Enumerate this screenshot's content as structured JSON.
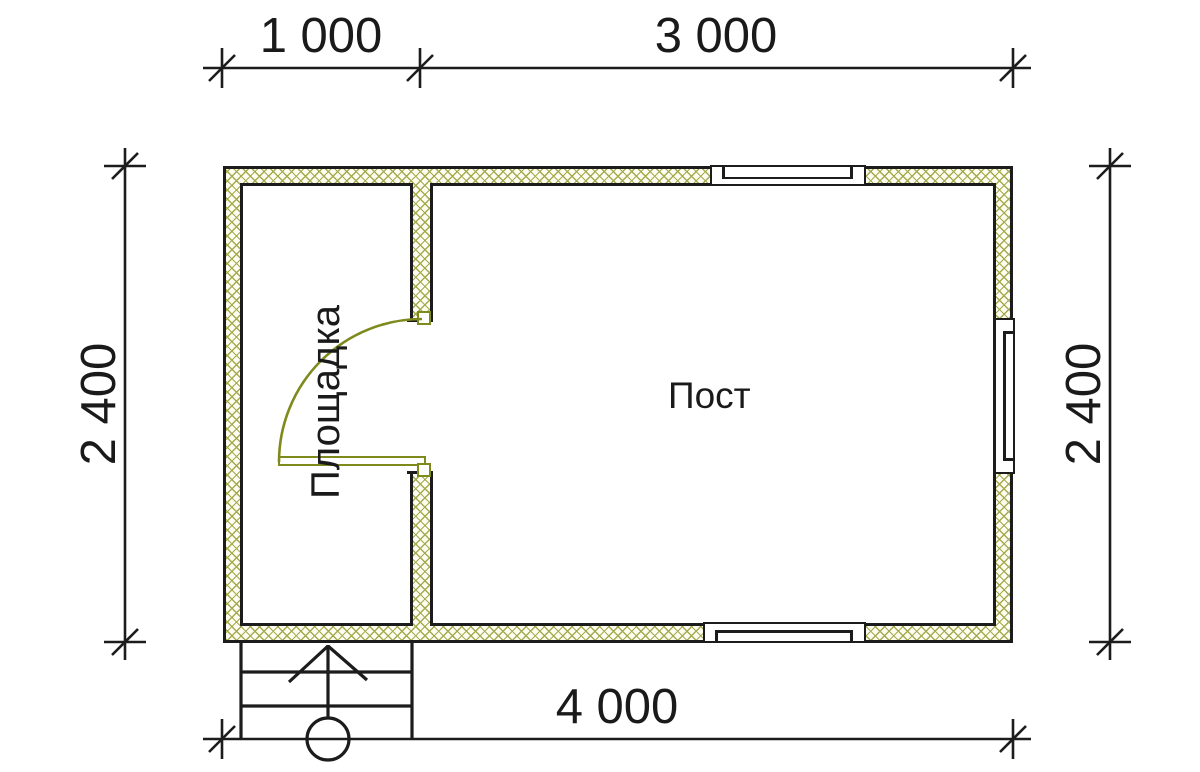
{
  "drawing": {
    "type": "floor-plan",
    "dimensions": {
      "top_segment_left": "1 000",
      "top_segment_right": "3 000",
      "side_left": "2 400",
      "side_right": "2 400",
      "bottom_total": "4 000"
    },
    "rooms": {
      "left_label": "Площадка",
      "right_label": "Пост"
    },
    "watermark": {
      "brand": "VANDA"
    }
  },
  "colors": {
    "line": "#1c1c1c",
    "hatch-line": "#a6aa4e",
    "hatch-bg": "#fdfdf1",
    "door": "#7f8a1d",
    "wm-pink": "#f7c6ca",
    "wm-blue": "#ccd9eb",
    "wm-top-left": "#d8e9f6",
    "wm-top-right": "#e2eef9",
    "wm-text": "#ffffff",
    "text": "#1a1a1a"
  }
}
